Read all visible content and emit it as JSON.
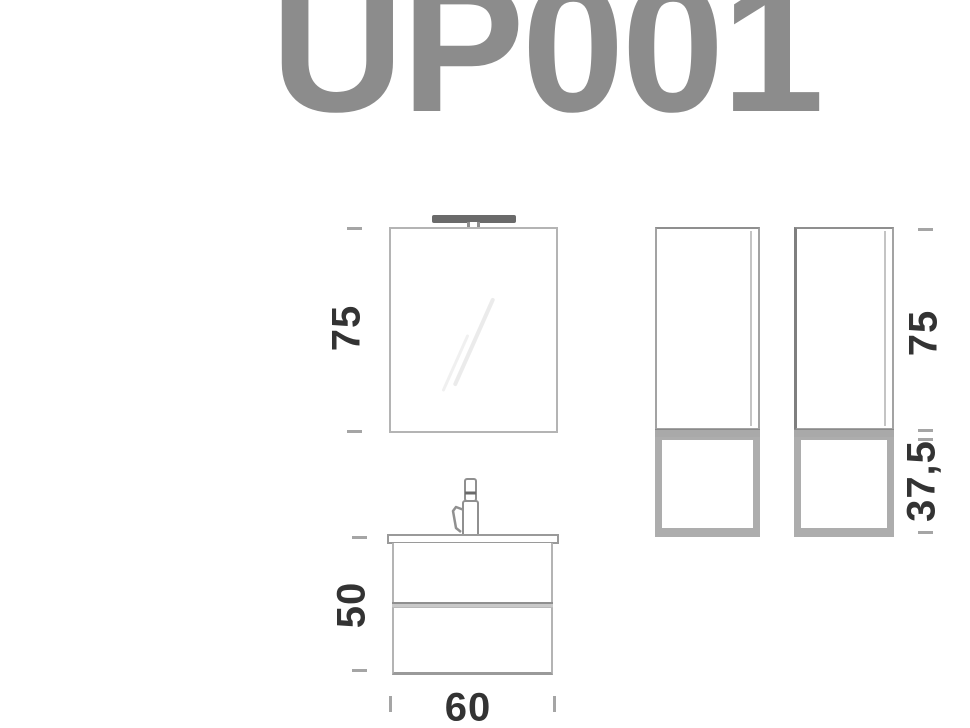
{
  "title": "UP001",
  "colors": {
    "background": "#ffffff",
    "title": "#8c8c8c",
    "line_light": "#b4b4b4",
    "line_mid": "#9a9a9a",
    "frame_gray": "#a9a9a9",
    "lamp_dark": "#6a6a6a",
    "dim_text": "#333333",
    "tick": "#a5a5a5",
    "reflection": "#ebebeb"
  },
  "drawing": {
    "mirror": {
      "component": "mirror-with-lamp",
      "height_label": "75"
    },
    "vanity": {
      "component": "washbasin-cabinet-with-faucet",
      "height_label": "50",
      "width_label": "60"
    },
    "side_columns": {
      "component": "two-tall-side-cabinets",
      "upper_height_label": "75",
      "lower_height_label": "37,5"
    }
  }
}
